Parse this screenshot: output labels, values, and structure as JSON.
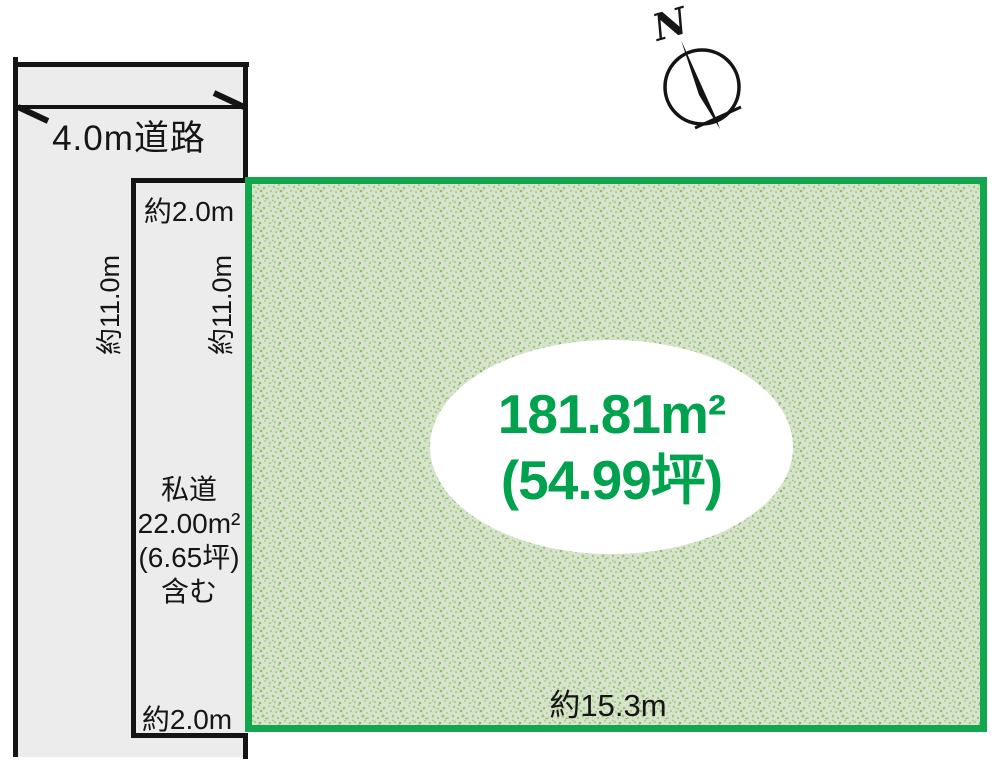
{
  "diagram": {
    "compass": {
      "north_label": "N"
    },
    "road": {
      "width_label": "4.0m道路",
      "depth_label": "約11.0m"
    },
    "private_road": {
      "top_width_label": "約2.0m",
      "depth_label": "約11.0m",
      "note_lines": [
        "私道",
        "22.00m²",
        "(6.65坪)",
        "含む"
      ],
      "bottom_width_label": "約2.0m"
    },
    "plot": {
      "area_sqm": "181.81m²",
      "area_tsubo": "(54.99坪)",
      "frontage_label": "約15.3m"
    },
    "colors": {
      "line": "#141414",
      "road_fill": "#ececec",
      "plot_border": "#12a74e",
      "plot_fill": "#d8e3cf",
      "speckle": "#9ec973",
      "area_text": "#00a24e"
    }
  }
}
